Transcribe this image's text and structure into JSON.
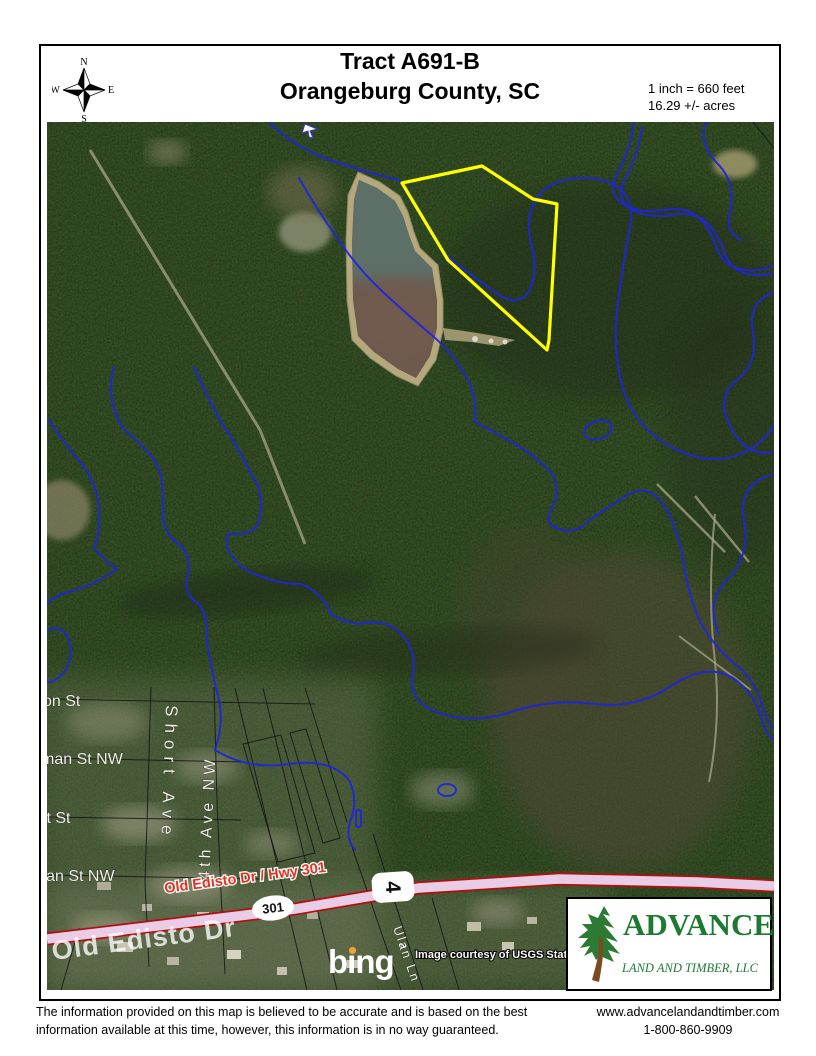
{
  "header": {
    "title_line1": "Tract A691-B",
    "title_line2": "Orangeburg County, SC",
    "scale": "1 inch = 660 feet",
    "acreage": "16.29 +/- acres"
  },
  "compass": {
    "n": "N",
    "e": "E",
    "s": "S",
    "w": "W"
  },
  "map": {
    "street_labels": {
      "on_st": "on St",
      "man_st_nw": "man St NW",
      "tt_st": "tt St",
      "lian_st_nw": "lian St NW",
      "short_ave": "Short Ave",
      "fourth_ave_nw": "4th Ave NW",
      "ulan_ln": "Ulan Ln"
    },
    "highway": {
      "label": "Old Edisto Dr / Hwy 301",
      "on_road_label": "Old Edisto Dr",
      "shield_301": "301",
      "shield_4": "4"
    },
    "credits": {
      "provider": "bing",
      "trademark": "™",
      "imagery": "Image courtesy of USGS State"
    },
    "colors": {
      "contour_blue": "#1f25dd",
      "tract_yellow": "#ffff00",
      "highway_pink": "#e9cde7",
      "highway_red": "#b30f0f",
      "road_label_red": "#e5311f"
    }
  },
  "logo": {
    "brand": "ADVANCE",
    "subtitle": "LAND AND TIMBER, LLC"
  },
  "footer": {
    "disclaimer1": "The information provided on this map is believed to be accurate and is based on the best",
    "disclaimer2": "information available at this time, however, this information is in no way guaranteed.",
    "website": "www.advancelandandtimber.com",
    "phone": "1-800-860-9909"
  }
}
